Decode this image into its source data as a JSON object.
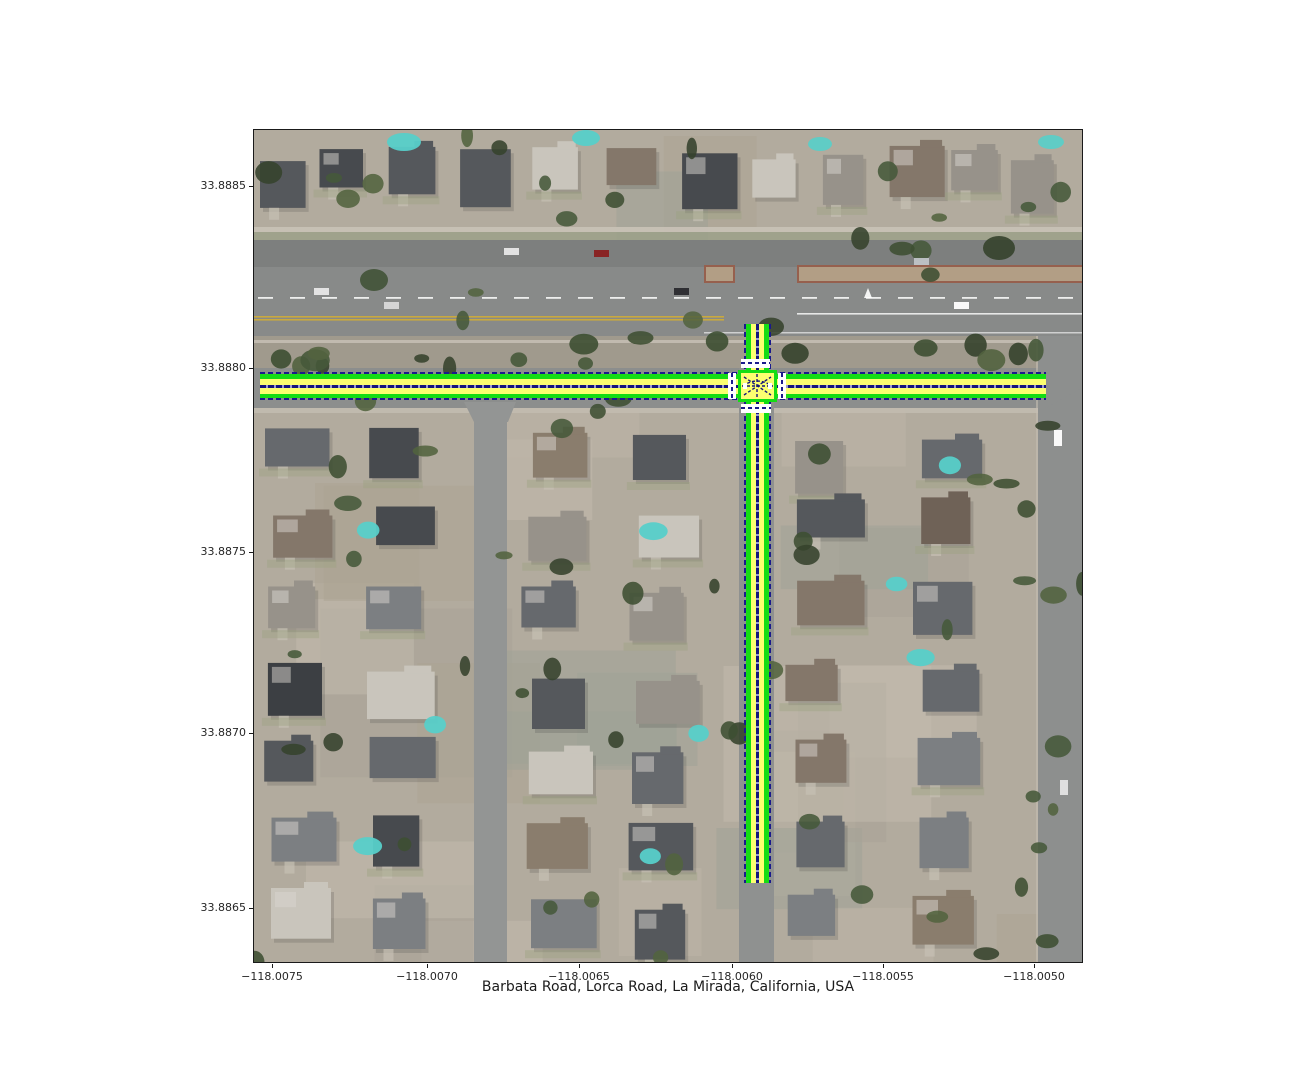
{
  "figure": {
    "title": "Barbata Road, Lorca Road, La Mirada, California, USA",
    "x_axis": {
      "tick_labels": [
        "−118.0075",
        "−118.0070",
        "−118.0065",
        "−118.0060",
        "−118.0055",
        "−118.0050"
      ]
    },
    "y_axis": {
      "tick_labels": [
        "33.8885",
        "33.8880",
        "33.8875",
        "33.8870",
        "33.8865"
      ]
    }
  },
  "map": {
    "imagery": "aerial-photo-residential-neighborhood",
    "route_overlay": {
      "streets": [
        "Barbata Road",
        "Lorca Road"
      ],
      "structure": "east-west road with south branch and short north stub meeting at a crosswalk-marked intersection",
      "colors": {
        "edge_green": "#14dd14",
        "lane_yellow": "#fcff70",
        "centerline_navy": "#1a1a8c",
        "crosswalk_white": "#ffffff"
      }
    }
  }
}
